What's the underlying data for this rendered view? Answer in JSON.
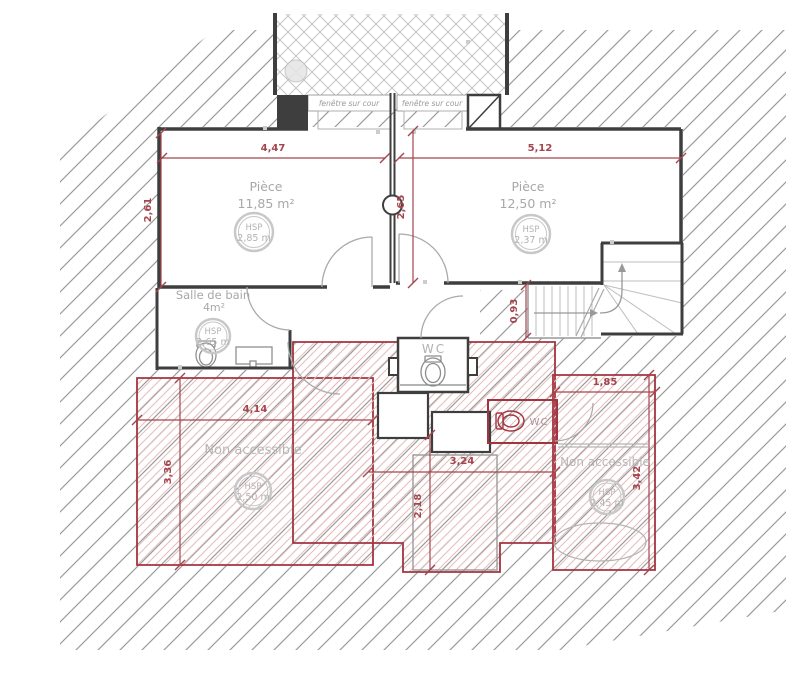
{
  "windows": {
    "left_label": "fenêtre sur cour",
    "right_label": "fenêtre sur cour"
  },
  "rooms": {
    "room1": {
      "name": "Pièce",
      "area": "11,85 m²",
      "hsp_title": "HSP",
      "hsp": "2,85 m"
    },
    "room2": {
      "name": "Pièce",
      "area": "12,50 m²",
      "hsp_title": "HSP",
      "hsp": "2,37 m"
    },
    "bathroom": {
      "name": "Salle de bain",
      "area": "4m²",
      "hsp_title": "HSP",
      "hsp": "2,65 m"
    },
    "wc": {
      "name": "WC"
    },
    "wc2": {
      "name": "WC"
    },
    "na_left": {
      "name": "Non accessible",
      "hsp_title": "HSP",
      "hsp": "2,50 m"
    },
    "na_right": {
      "name": "Non accessible",
      "hsp_title": "HSP",
      "hsp": "2,45 m"
    }
  },
  "dimensions": {
    "room1_width": "4,47",
    "room2_width": "5,12",
    "room1_height": "2,61",
    "center_height": "2,65",
    "stair_height": "0,93",
    "na_left_width": "4,14",
    "na_left_height": "3,36",
    "center_width": "3,24",
    "center_lower_height": "2,18",
    "na_right_width": "1,85",
    "na_right_height": "3,42"
  },
  "colors": {
    "dimension": "#a4454d",
    "red_zone": "#a23440",
    "wall": "#3e3e3e",
    "label": "#a8a8a8"
  }
}
